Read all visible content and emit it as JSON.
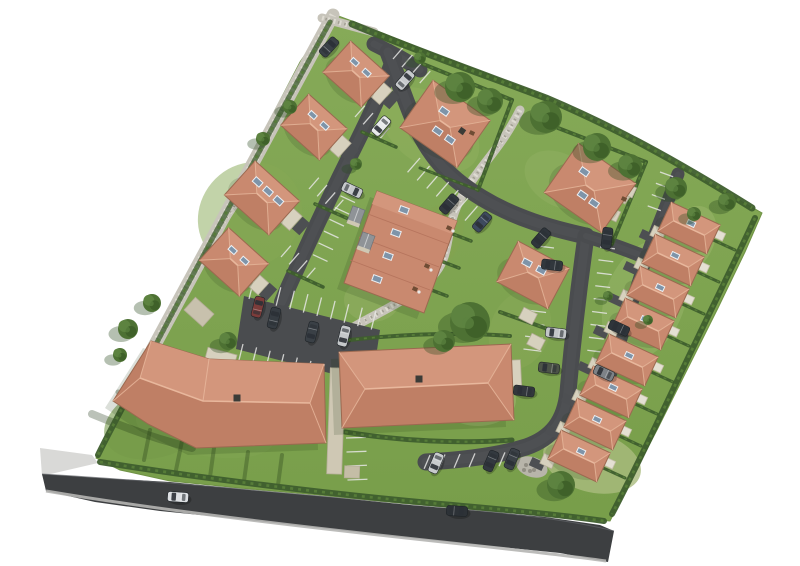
{
  "meta": {
    "type": "aerial-3d-site-plan",
    "description": "Aerial 3D rendering of a residential housing development site plan on a white background",
    "background": "#ffffff"
  },
  "palette": {
    "grassTop": "#86aa58",
    "grassBottom": "#789e4a",
    "hedge": "#3e5e2d",
    "hedgeLight": "#567c38",
    "treeBase": "#4d7133",
    "treeLight": "#5d8340",
    "treeDark": "#3f6129",
    "treeShadow": "#2b4a20",
    "roofLight": "#d3967c",
    "roofMid": "#c9896f",
    "roofDark": "#bf7f65",
    "ridge": "#e8b79c",
    "eave": "#9b6950",
    "road": "#4a4c4f",
    "roadDark": "#3d3f41",
    "roadLine": "#e6e6e4",
    "gravel": "#c7c4ba",
    "gravelLight": "#dedbd2",
    "gravelDark": "#a29f93",
    "garage": "#d7d1be",
    "garageEdge": "#b4ad97",
    "terrace": "#e4e0d3",
    "terraceEdge": "#c6c0ab",
    "skyGlass": "#7e94a9",
    "skyFrame": "#eef1f4",
    "chimney": "#3b3b37",
    "sidewalk": "#d9d9d7",
    "curb": "#b5b5b3",
    "shadow": "#1d3513",
    "drive": "#4d4f52",
    "grayGarage": "#8f9397",
    "table": "#6f4c34"
  },
  "site": {
    "outline": "333,14 360,24 420,48 480,71 545,96 610,128 672,162 725,192 762,213 745,252 718,308 688,368 658,428 630,482 610,521 560,517 480,510 400,503 320,495 240,488 170,481 120,470 96,458 130,390 170,312 215,225 262,135 300,62",
    "patches": [
      [
        430,
        130,
        55,
        35,
        35,
        "#8fae5d",
        0.55
      ],
      [
        250,
        215,
        50,
        55,
        40,
        "#85a754",
        0.5
      ],
      [
        560,
        180,
        38,
        26,
        30,
        "#93b263",
        0.45
      ],
      [
        645,
        300,
        40,
        62,
        20,
        "#9cb76c",
        0.45
      ],
      [
        592,
        462,
        50,
        30,
        15,
        "#aabc7e",
        0.8
      ],
      [
        478,
        400,
        38,
        26,
        0,
        "#a3b873",
        0.5
      ],
      [
        160,
        420,
        58,
        36,
        -20,
        "#74994a",
        0.6
      ],
      [
        690,
        240,
        24,
        36,
        25,
        "#a3bb73",
        0.4
      ],
      [
        372,
        300,
        28,
        22,
        0,
        "#96b266",
        0.45
      ],
      [
        205,
        430,
        70,
        26,
        10,
        "#7fa452",
        0.5
      ],
      [
        520,
        330,
        30,
        40,
        20,
        "#8cab5b",
        0.4
      ],
      [
        435,
        240,
        24,
        40,
        30,
        "#84a34f",
        0.4
      ]
    ]
  },
  "publicRoad": {
    "poly": "42,474 100,478 170,482 250,490 330,497 410,505 480,511 545,517 600,525 614,531 608,562 560,553 480,545 400,537 320,528 240,519 160,511 95,502 46,491",
    "topEdge": "M42,474 C160,481 300,494 430,506 C520,514 575,521 614,531",
    "bottomEdge": "M46,491 C170,512 330,530 480,546 C535,552 580,557 606,561",
    "sidewalk": "40,448 92,455 98,463 42,476"
  },
  "gravel": {
    "paths": [
      {
        "d": "M333,15 L152,350",
        "w": 13
      },
      {
        "d": "M322,18 L374,32",
        "w": 9
      },
      {
        "d": "M520,110 C500,150 480,165 462,196 C444,227 452,252 436,272 C420,293 392,306 368,319 C350,328 338,338 331,346",
        "w": 9
      },
      {
        "d": "M252,182 C238,200 228,215 217,233",
        "w": 7
      }
    ],
    "mound": [
      532,
      467,
      16,
      10,
      18
    ]
  },
  "roads": [
    {
      "d": "M374,44 C390,52 406,60 420,70",
      "w": 15
    },
    {
      "d": "M394,58 C384,86 368,120 352,152 C334,188 316,226 298,266 C291,281 286,292 282,302",
      "w": 16
    },
    {
      "d": "M388,52 C398,78 404,98 416,126 C432,160 452,180 482,198 C515,218 550,228 586,236",
      "w": 17
    },
    {
      "d": "M586,236 C579,286 573,336 568,392 C565,421 552,438 526,447 C497,456 462,460 426,462",
      "w": 17
    },
    {
      "d": "M586,236 C602,241 622,248 640,255",
      "w": 14
    },
    {
      "d": "M678,174 C668,202 656,230 646,258 C634,296 620,340 606,390",
      "w": 13
    }
  ],
  "parkingLot": "244,296 380,330 372,384 236,349",
  "stallGroups": [
    {
      "x": 420,
      "y": 158,
      "rowA": 40,
      "stallA": 131,
      "n": 7,
      "sp": 12.5,
      "len": 19
    },
    {
      "x": 393,
      "y": 59,
      "rowA": 42,
      "stallA": -49,
      "n": 3,
      "sp": 12,
      "len": 16
    },
    {
      "x": 355,
      "y": 117,
      "rowA": 42,
      "stallA": -49,
      "n": 3,
      "sp": 11,
      "len": 15
    },
    {
      "x": 309,
      "y": 189,
      "rowA": 42,
      "stallA": -49,
      "n": 3,
      "sp": 11,
      "len": 15
    },
    {
      "x": 281,
      "y": 257,
      "rowA": 42,
      "stallA": -49,
      "n": 3,
      "sp": 11,
      "len": 15
    },
    {
      "x": 554,
      "y": 248,
      "rowA": 97,
      "stallA": 187,
      "n": 8,
      "sp": 13,
      "len": 18
    },
    {
      "x": 600,
      "y": 247,
      "rowA": 97,
      "stallA": 7,
      "n": 8,
      "sp": 13,
      "len": 15
    },
    {
      "x": 249,
      "y": 299,
      "rowA": 14,
      "stallA": -76,
      "n": 9,
      "sp": 14,
      "len": 19
    },
    {
      "x": 243,
      "y": 344,
      "rowA": 14,
      "stallA": 104,
      "n": 9,
      "sp": 14,
      "len": 19
    },
    {
      "x": 430,
      "y": 455,
      "rowA": -2,
      "stallA": 113,
      "n": 6,
      "sp": 15,
      "len": 15
    },
    {
      "x": 346,
      "y": 184,
      "rowA": 115,
      "stallA": 25,
      "n": 6,
      "sp": 13,
      "len": 16
    },
    {
      "x": 346,
      "y": 438,
      "rowA": 88,
      "stallA": -2,
      "n": 3,
      "sp": 14,
      "len": 20
    },
    {
      "x": 660,
      "y": 172,
      "rowA": 110,
      "stallA": 20,
      "n": 3,
      "sp": 12,
      "len": 14
    }
  ],
  "hedges": [
    {
      "d": "M352,24 C420,52 482,74 546,98 C612,126 672,158 752,208",
      "w": 7
    },
    {
      "d": "M755,218 C730,272 700,332 670,396 C650,438 630,480 612,514",
      "w": 6
    },
    {
      "d": "M100,462 C200,478 320,493 430,503 C510,510 562,515 604,521",
      "w": 6
    },
    {
      "d": "M330,22 C272,128 212,238 154,348",
      "w": 5,
      "o": 0.75
    },
    {
      "d": "M150,352 C133,390 113,424 98,455",
      "w": 6
    }
  ],
  "gardenHedges": [
    {
      "d": "M423,64 L512,100",
      "w": 4
    },
    {
      "d": "M512,100 L478,190",
      "w": 4
    },
    {
      "d": "M478,190 L420,168",
      "w": 3
    },
    {
      "d": "M558,128 L646,162",
      "w": 4
    },
    {
      "d": "M646,162 L612,244",
      "w": 4
    },
    {
      "d": "M432,226 L471,241",
      "w": 3.5
    },
    {
      "d": "M420,253 L459,268",
      "w": 3.5
    },
    {
      "d": "M408,281 L447,296",
      "w": 3.5
    },
    {
      "d": "M362,132 L396,147",
      "w": 3.5
    },
    {
      "d": "M315,204 L351,220",
      "w": 3.5
    },
    {
      "d": "M288,271 L323,287",
      "w": 3.5
    },
    {
      "d": "M345,432 C400,441 460,444 512,440",
      "w": 5
    },
    {
      "d": "M340,341 C400,334 460,332 510,336",
      "w": 4
    },
    {
      "d": "M500,312 L556,332",
      "w": 4
    }
  ],
  "shadowStreaks": [
    {
      "d": "M92,414 C130,430 160,440 192,448",
      "w": 8
    },
    {
      "d": "M150,430 L144,460",
      "w": 4
    },
    {
      "d": "M182,441 L176,470",
      "w": 4
    },
    {
      "d": "M214,448 L210,477",
      "w": 4
    },
    {
      "d": "M248,452 L244,481",
      "w": 4
    },
    {
      "d": "M282,455 L278,485",
      "w": 4
    },
    {
      "d": "M118,392 L170,412",
      "w": 5
    }
  ],
  "buildings": {
    "hipHouses": [
      {
        "cx": 356,
        "cy": 74,
        "w": 52,
        "h": 42,
        "rot": 42,
        "sky": [
          [
            -9,
            -8
          ],
          [
            7,
            -8
          ]
        ]
      },
      {
        "cx": 314,
        "cy": 127,
        "w": 52,
        "h": 42,
        "rot": 42,
        "sky": [
          [
            -9,
            -8
          ],
          [
            7,
            -8
          ]
        ]
      },
      {
        "cx": 262,
        "cy": 198,
        "w": 60,
        "h": 46,
        "rot": 42,
        "sky": [
          [
            -14,
            -9
          ],
          [
            0,
            -9
          ],
          [
            14,
            -9
          ]
        ]
      },
      {
        "cx": 234,
        "cy": 262,
        "w": 54,
        "h": 44,
        "rot": 42,
        "sky": [
          [
            -9,
            -8
          ],
          [
            7,
            -8
          ]
        ]
      },
      {
        "cx": 445,
        "cy": 124,
        "w": 70,
        "h": 58,
        "rot": 35,
        "sky": [
          [
            -8,
            -10
          ],
          [
            -2,
            10
          ],
          [
            13,
            10
          ]
        ],
        "chim": [
          18,
          -4
        ]
      },
      {
        "cx": 590,
        "cy": 188,
        "w": 70,
        "h": 60,
        "rot": 35,
        "sky": [
          [
            -14,
            -10
          ],
          [
            -2,
            10
          ],
          [
            12,
            10
          ]
        ]
      },
      {
        "cx": 533,
        "cy": 275,
        "w": 58,
        "h": 46,
        "rot": 28,
        "sky": [
          [
            -11,
            -8
          ],
          [
            5,
            -8
          ]
        ]
      }
    ],
    "rightRowStyle": {
      "w": 54,
      "h": 32,
      "rot": 25,
      "sky": [
        [
          0,
          -5
        ]
      ]
    },
    "rightRowUnits": [
      [
        689,
        228
      ],
      [
        673,
        260
      ],
      [
        658,
        292
      ],
      [
        643,
        324
      ],
      [
        627,
        360
      ],
      [
        611,
        392
      ],
      [
        595,
        424
      ],
      [
        579,
        456
      ]
    ],
    "cluster": {
      "outline": [
        [
          377,
          191
        ],
        [
          457,
          221
        ],
        [
          424,
          313
        ],
        [
          344,
          283
        ]
      ],
      "ridgeBand": [
        [
          377,
          191
        ],
        [
          457,
          221
        ],
        [
          452,
          234
        ],
        [
          372,
          204
        ]
      ],
      "divLines": [
        [
          [
            368,
            214
          ],
          [
            448,
            244
          ]
        ],
        [
          [
            359,
            237
          ],
          [
            439,
            267
          ]
        ],
        [
          [
            350,
            260
          ],
          [
            430,
            290
          ]
        ]
      ],
      "sky": [
        [
          404,
          210
        ],
        [
          396,
          233
        ],
        [
          388,
          256
        ],
        [
          377,
          279
        ]
      ],
      "skyRot": 20,
      "garages": [
        [
          356,
          216
        ],
        [
          366,
          242
        ]
      ]
    },
    "bent": {
      "outline": [
        [
          113,
          401
        ],
        [
          151,
          341
        ],
        [
          209,
          359
        ],
        [
          324,
          364
        ],
        [
          326,
          443
        ],
        [
          196,
          448
        ],
        [
          148,
          424
        ]
      ],
      "upperFace": [
        [
          151,
          341
        ],
        [
          209,
          359
        ],
        [
          324,
          364
        ],
        [
          310,
          403
        ],
        [
          203,
          401
        ],
        [
          140,
          378
        ]
      ],
      "ridge": [
        [
          140,
          378
        ],
        [
          203,
          401
        ],
        [
          310,
          403
        ]
      ],
      "hips": [
        [
          [
            140,
            378
          ],
          [
            113,
            401
          ]
        ],
        [
          [
            140,
            378
          ],
          [
            151,
            341
          ]
        ],
        [
          [
            310,
            403
          ],
          [
            324,
            364
          ]
        ],
        [
          [
            310,
            403
          ],
          [
            326,
            443
          ]
        ],
        [
          [
            203,
            401
          ],
          [
            209,
            359
          ]
        ]
      ],
      "chimney": [
        237,
        398
      ]
    },
    "center": {
      "corners": [
        [
          339,
          352
        ],
        [
          511,
          344
        ],
        [
          514,
          420
        ],
        [
          342,
          428
        ]
      ],
      "ridge": [
        [
          365,
          389
        ],
        [
          488,
          383
        ]
      ],
      "chimney": [
        419,
        379
      ]
    }
  },
  "beigeBoxes": [
    {
      "cx": 381,
      "cy": 93,
      "w": 13,
      "h": 19,
      "rot": 42
    },
    {
      "cx": 340,
      "cy": 146,
      "w": 13,
      "h": 19,
      "rot": 42
    },
    {
      "cx": 291,
      "cy": 219,
      "w": 13,
      "h": 19,
      "rot": 42
    },
    {
      "cx": 259,
      "cy": 285,
      "w": 12,
      "h": 16,
      "rot": 42
    },
    {
      "cx": 199,
      "cy": 312,
      "w": 25,
      "h": 17,
      "rot": 42,
      "fill": "#c8c1ad"
    },
    {
      "cx": 221,
      "cy": 357,
      "w": 30,
      "h": 12,
      "rot": 15
    },
    {
      "cx": 336,
      "cy": 421,
      "w": 15,
      "h": 106,
      "rot": 2,
      "fill": "#cfc8b4"
    },
    {
      "cx": 352,
      "cy": 472,
      "w": 15,
      "h": 12,
      "rot": 2,
      "fill": "#c4bda6"
    },
    {
      "cx": 470,
      "cy": 131,
      "w": 16,
      "h": 12,
      "rot": 35,
      "fill": "#c8c1ad"
    },
    {
      "cx": 622,
      "cy": 196,
      "w": 14,
      "h": 10,
      "rot": 35,
      "fill": "#c8c1ad"
    },
    {
      "cx": 516,
      "cy": 373,
      "w": 10,
      "h": 26,
      "rot": -3
    },
    {
      "cx": 528,
      "cy": 316,
      "w": 15,
      "h": 12,
      "rot": 27
    },
    {
      "cx": 536,
      "cy": 342,
      "w": 15,
      "h": 12,
      "rot": 27
    },
    {
      "cx": 612,
      "cy": 214,
      "w": 14,
      "h": 11,
      "rot": 25
    },
    {
      "cx": 628,
      "cy": 190,
      "w": 14,
      "h": 11,
      "rot": 25
    }
  ],
  "driveways": [
    {
      "cx": 391,
      "cy": 100
    },
    {
      "cx": 350,
      "cy": 153
    },
    {
      "cx": 301,
      "cy": 226
    },
    {
      "cx": 268,
      "cy": 292
    }
  ],
  "trees": [
    [
      460,
      87,
      15
    ],
    [
      490,
      101,
      13
    ],
    [
      546,
      117,
      16
    ],
    [
      597,
      147,
      14
    ],
    [
      630,
      166,
      12
    ],
    [
      676,
      188,
      11
    ],
    [
      727,
      202,
      9
    ],
    [
      470,
      322,
      20
    ],
    [
      444,
      341,
      11
    ],
    [
      561,
      485,
      14
    ],
    [
      152,
      303,
      9
    ],
    [
      128,
      329,
      10
    ],
    [
      263,
      139,
      7
    ],
    [
      290,
      107,
      7
    ],
    [
      356,
      164,
      6
    ],
    [
      694,
      214,
      7
    ],
    [
      228,
      341,
      9
    ],
    [
      120,
      355,
      7
    ],
    [
      420,
      58,
      6
    ],
    [
      608,
      296,
      5
    ],
    [
      648,
      320,
      5
    ]
  ],
  "cars": [
    [
      381,
      126,
      131,
      "#e8eaeb"
    ],
    [
      405,
      80,
      -49,
      "#c7cacc"
    ],
    [
      329,
      47,
      -48,
      "#3a4046"
    ],
    [
      449,
      204,
      131,
      "#33393f"
    ],
    [
      482,
      222,
      131,
      "#3e4a5e"
    ],
    [
      541,
      238,
      131,
      "#2f353b"
    ],
    [
      552,
      265,
      187,
      "#31373d"
    ],
    [
      556,
      333,
      187,
      "#c3c6c8"
    ],
    [
      549,
      368,
      187,
      "#4c5348"
    ],
    [
      524,
      391,
      187,
      "#32373c"
    ],
    [
      619,
      328,
      205,
      "#2e343a"
    ],
    [
      604,
      373,
      205,
      "#7d8287"
    ],
    [
      607,
      238,
      97,
      "#31373d"
    ],
    [
      258,
      307,
      -76,
      "#7c3c3a"
    ],
    [
      274,
      318,
      -76,
      "#363c42"
    ],
    [
      344,
      336,
      104,
      "#c5c8ca"
    ],
    [
      312,
      332,
      104,
      "#3a4046"
    ],
    [
      352,
      190,
      25,
      "#c6c9cb"
    ],
    [
      436,
      463,
      113,
      "#c8cbcd"
    ],
    [
      491,
      461,
      113,
      "#33393f"
    ],
    [
      512,
      459,
      113,
      "#3b4147"
    ],
    [
      178,
      497,
      184,
      "#dde0e3"
    ],
    [
      457,
      511,
      4,
      "#2d3237"
    ]
  ],
  "tables": [
    [
      449,
      228
    ],
    [
      427,
      266
    ],
    [
      415,
      289
    ],
    [
      472,
      133
    ],
    [
      624,
      199
    ]
  ],
  "chairDots": [
    [
      453,
      231
    ],
    [
      431,
      270
    ],
    [
      419,
      292
    ]
  ],
  "counts": {
    "hip_houses": 7,
    "cluster_units": 4,
    "right_row_units": 8,
    "large_buildings": 2,
    "cars": 23,
    "trees": 21
  }
}
